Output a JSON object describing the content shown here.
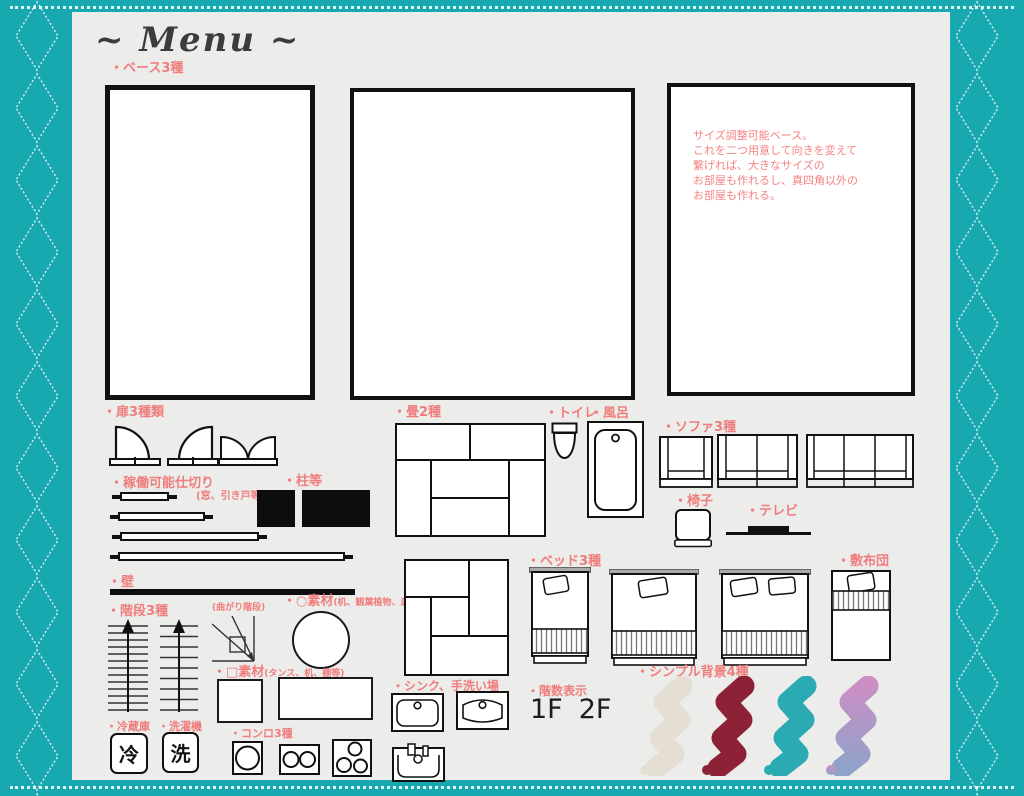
{
  "window": {
    "title": "~ Menu ~"
  },
  "colors": {
    "border_teal": "#17a8b0",
    "content_bg": "#ececea",
    "label_pink": "#ef7d7c",
    "ink": "#111111"
  },
  "sections": {
    "base": {
      "label": "・ベース3種",
      "note": "サイズ調整可能ベース。\nこれを二つ用意して向きを変えて\n繋げれば、大きなサイズの\nお部屋も作れるし、真四角以外の\nお部屋も作れる。"
    },
    "doors": {
      "label": "・扉3種類"
    },
    "partition": {
      "label": "・稼働可能仕切り",
      "sub": "(窓、引き戸等)"
    },
    "pillar": {
      "label": "・柱等"
    },
    "wall": {
      "label": "・壁"
    },
    "stairs": {
      "label": "・階段3種",
      "sub": "(曲がり階段)"
    },
    "circle_material": {
      "label": "・○素材",
      "sub": "(机、観葉植物、皿等)"
    },
    "square_material": {
      "label": "・□素材",
      "sub": "(タンス、机、棚等)"
    },
    "fridge": {
      "label": "・冷蔵庫",
      "glyph": "冷"
    },
    "washer": {
      "label": "・洗濯機",
      "glyph": "洗"
    },
    "stove": {
      "label": "・コンロ3種"
    },
    "tatami": {
      "label": "・畳2種"
    },
    "toilet": {
      "label": "・トイレ"
    },
    "bath": {
      "label": "・風呂"
    },
    "sofa": {
      "label": "・ソファ3種"
    },
    "chair": {
      "label": "・椅子"
    },
    "tv": {
      "label": "・テレビ"
    },
    "bed": {
      "label": "・ベッド3種"
    },
    "futon": {
      "label": "・敷布団"
    },
    "sink": {
      "label": "・シンク、手洗い場"
    },
    "floor_indicator": {
      "label": "・階数表示",
      "values": [
        "1F",
        "2F"
      ]
    },
    "backgrounds": {
      "label": "・シンプル背景4種",
      "colors": [
        "#e4ded3",
        "#8d2136",
        "#2caab3"
      ],
      "gradient": [
        "#cb8fc5",
        "#8fa2c9"
      ]
    }
  }
}
